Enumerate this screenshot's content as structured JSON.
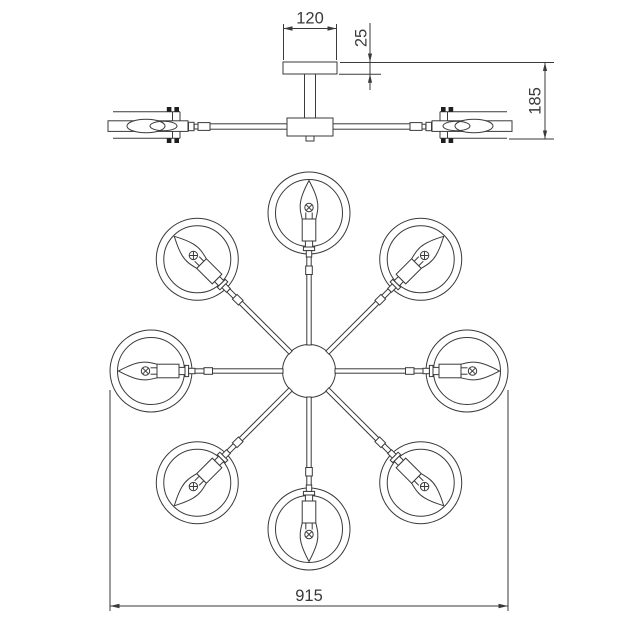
{
  "figure": {
    "kind": "technical-dimension-drawing",
    "subject": "8-arm ceiling chandelier, elevation and plan views",
    "background": "#ffffff",
    "line_color": "#3a3a3a",
    "plan_view": {
      "lamp_count": 8,
      "angle_step_deg": 45
    },
    "side_view": {
      "visible_lamp_count": 2
    }
  },
  "dimensions": {
    "canopy_width": "120",
    "canopy_thickness": "25",
    "fixture_height": "185",
    "fixture_diameter": "915"
  }
}
